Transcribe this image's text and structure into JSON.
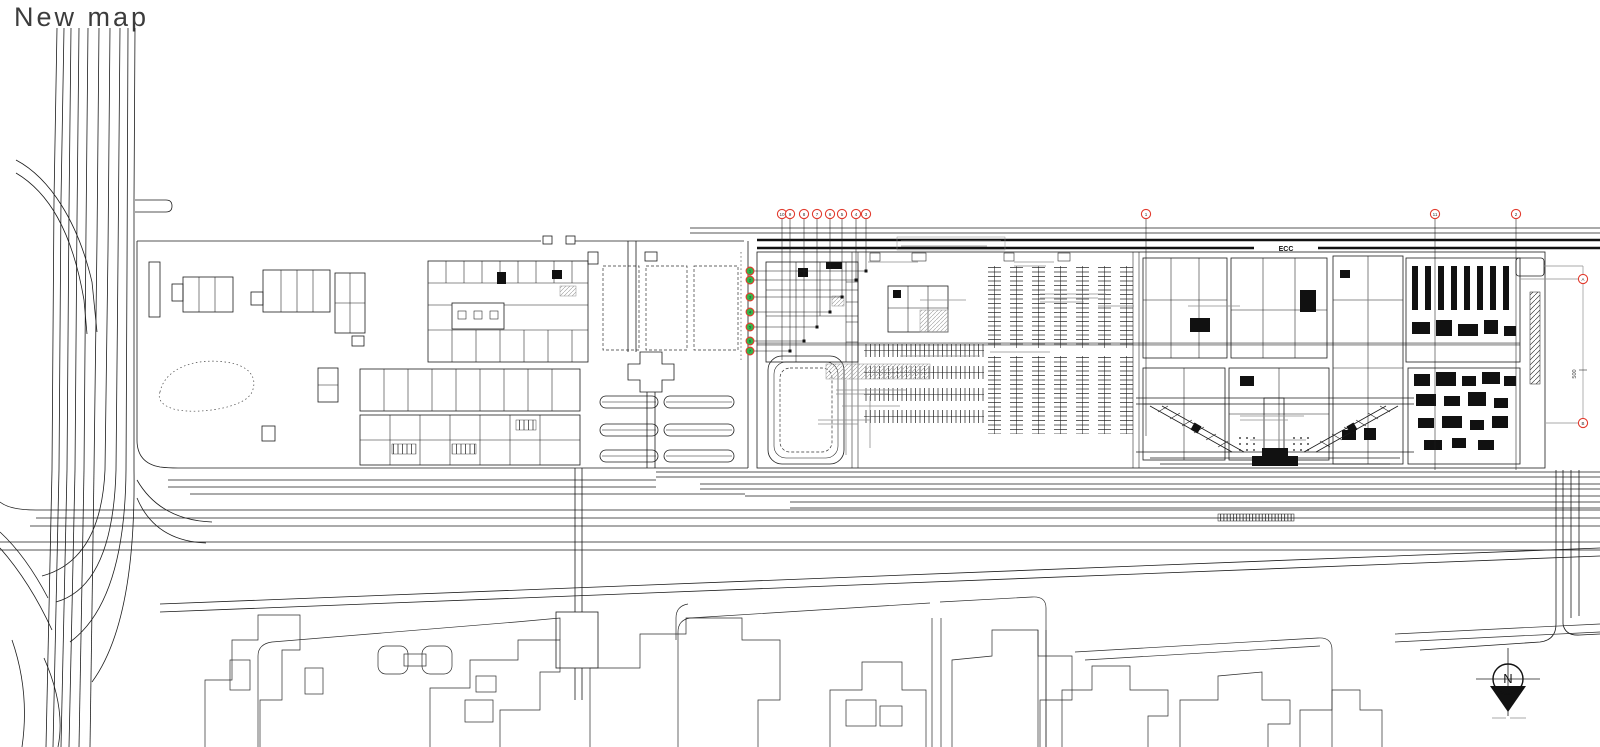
{
  "title": "New map",
  "colors": {
    "ink": "#1c1c1c",
    "annotation_gray": "#8f8f8f",
    "road_gray": "#b0b0b0",
    "callout_red": "#e23b2e",
    "callout_green": "#35b44a",
    "background": "#ffffff"
  },
  "labels": {
    "corridor": "ECC",
    "dimension": "500",
    "north_letter": "N"
  },
  "callouts": {
    "top": [
      {
        "label": "10"
      },
      {
        "label": "9"
      },
      {
        "label": "8"
      },
      {
        "label": "7"
      },
      {
        "label": "6"
      },
      {
        "label": "5"
      },
      {
        "label": "4"
      },
      {
        "label": "3"
      }
    ],
    "mid": {
      "label": "1"
    },
    "right_a": {
      "label": "11"
    },
    "right_b": {
      "label": "2"
    },
    "side_stack": [
      {
        "label": "1"
      },
      {
        "label": "2"
      },
      {
        "label": "3"
      },
      {
        "label": "4"
      },
      {
        "label": "5"
      },
      {
        "label": "6"
      },
      {
        "label": "7"
      }
    ],
    "dim_top": {
      "label": "A"
    },
    "dim_bottom": {
      "label": "B"
    }
  }
}
